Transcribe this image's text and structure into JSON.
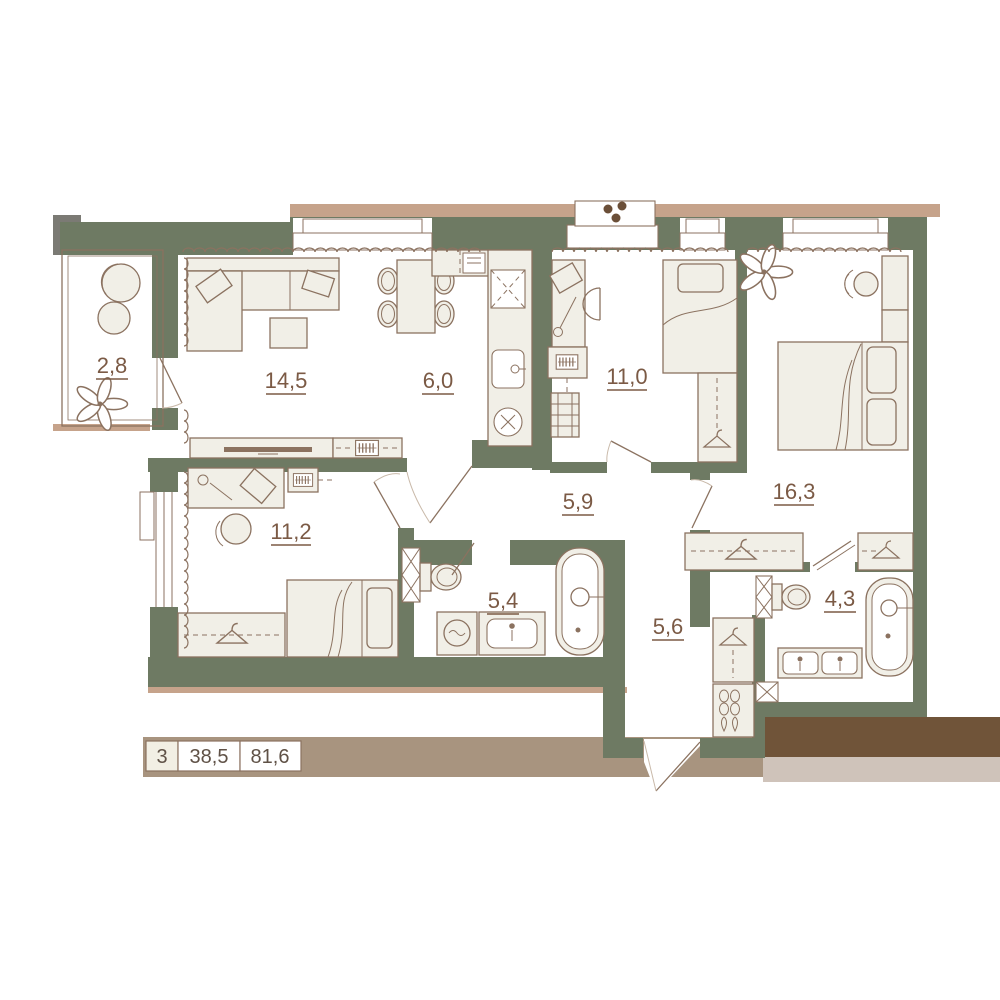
{
  "plan": {
    "rooms": [
      {
        "key": "balcony",
        "area": "2,8"
      },
      {
        "key": "living-room",
        "area": "14,5"
      },
      {
        "key": "kitchen",
        "area": "6,0"
      },
      {
        "key": "bedroom-top",
        "area": "11,0"
      },
      {
        "key": "bedroom-primary",
        "area": "16,3"
      },
      {
        "key": "bedroom-second",
        "area": "11,2"
      },
      {
        "key": "hallway",
        "area": "5,9"
      },
      {
        "key": "bathroom",
        "area": "5,4"
      },
      {
        "key": "corridor",
        "area": "5,6"
      },
      {
        "key": "bathroom-ensuite",
        "area": "4,3"
      }
    ],
    "legend": {
      "rooms_count": "3",
      "living_area": "38,5",
      "total_area": "81,6"
    },
    "icons": {
      "vent_fan": "fan-dots",
      "wardrobe": "hanger",
      "shoe_rack": "shoes",
      "greenery": "plant"
    },
    "colors": {
      "wall": "#6e7a63",
      "line": "#8b7260",
      "furniture_fill": "#f1efe7",
      "label_text": "#7b5a45",
      "legend_text": "#5f5146",
      "tan_band": "#c6a38b",
      "taupe_band": "#a8947f",
      "brown_band": "#705439",
      "light_band": "#cfc3ba",
      "faint": "#c9b9a9",
      "grey_block": "#7b7a74",
      "fan_dot": "#6b4f38",
      "cell_bg": "#f2efe4"
    }
  }
}
